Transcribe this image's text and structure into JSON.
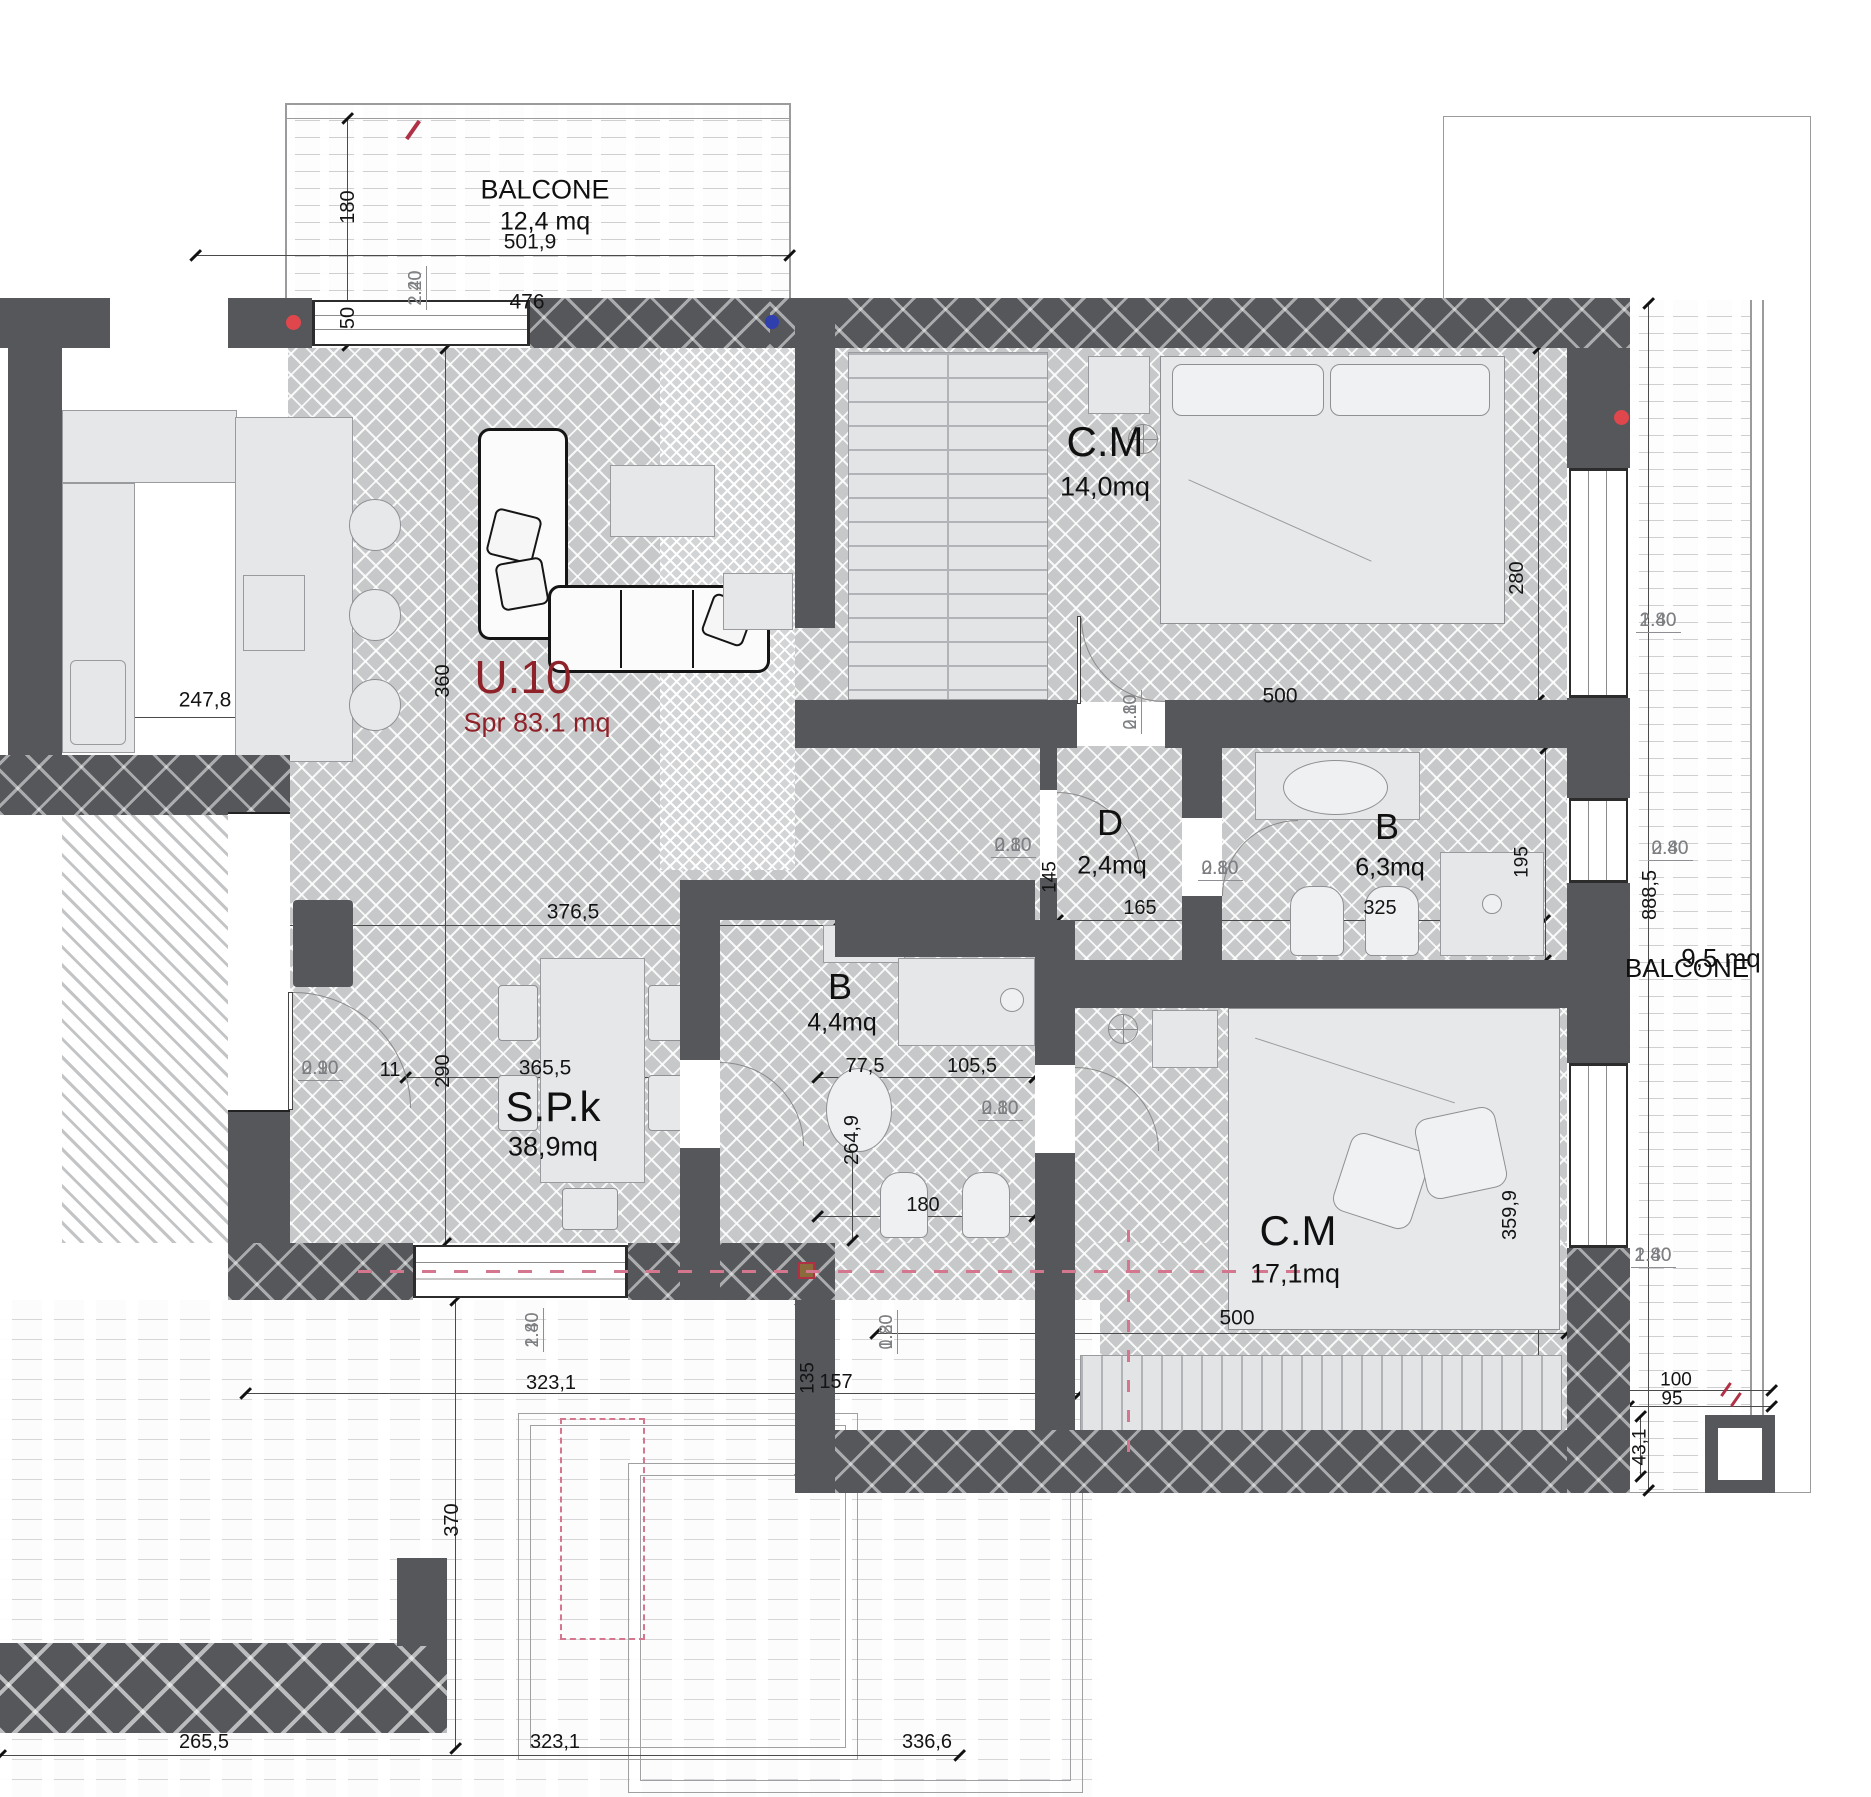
{
  "unit": {
    "id": "U.10",
    "area": "Spr 83.1 mq"
  },
  "rooms": {
    "balcony_top": {
      "name": "BALCONE",
      "area": "12,4 mq"
    },
    "bedroom_top": {
      "name": "C.M",
      "area": "14,0mq"
    },
    "hallway": {
      "name": "D",
      "area": "2,4mq"
    },
    "bathroom_main": {
      "name": "B",
      "area": "6,3mq"
    },
    "bathroom_small": {
      "name": "B",
      "area": "4,4mq"
    },
    "living": {
      "name": "S.P.k",
      "area": "38,9mq"
    },
    "bedroom_bottom": {
      "name": "C.M",
      "area": "17,1mq"
    },
    "balcony_right": {
      "name": "BALCONE",
      "area": "9,5 mq"
    }
  },
  "openings": {
    "balcony_door": {
      "w": "2.20",
      "h": "2.40"
    },
    "entry_door": {
      "w": "0.90",
      "h": "2.10"
    },
    "interior_door": {
      "w": "0.80",
      "h": "2.10"
    },
    "balcony_right_door": {
      "w": "0.80",
      "h": "2.40"
    },
    "window_large": {
      "w": "1.80",
      "h": "2.40"
    },
    "window_small": {
      "w": "0.80",
      "h": "1.20"
    }
  },
  "dims": {
    "balcony_top": {
      "width": "501,9",
      "window": "476",
      "depth": "180",
      "offset": "50"
    },
    "kitchen": {
      "width": "247,8"
    },
    "living": {
      "upper_width": "376,5",
      "upper_height": "360",
      "lower_width": "365,5",
      "lower_height": "290",
      "entry_jamb": "11"
    },
    "bedroom_top": {
      "width": "500",
      "height": "280"
    },
    "hallway": {
      "width": "165",
      "height": "145"
    },
    "bathroom_main": {
      "width": "325",
      "height": "195"
    },
    "bathroom_small": {
      "left": "77,5",
      "right": "105,5",
      "height": "264,9",
      "width": "180"
    },
    "bedroom_bottom": {
      "width": "500",
      "height": "359,9"
    },
    "balcony_right": {
      "length": "888,5",
      "offset_a": "100",
      "offset_b": "95",
      "offset_c": "43,1"
    },
    "terrace": {
      "width": "323,1",
      "depth_a": "135",
      "depth_b": "157",
      "height": "370"
    },
    "bottom_row": {
      "left": "265,5",
      "middle": "323,1",
      "right": "336,6"
    }
  },
  "colors": {
    "wall": "#55575b",
    "floor": "#c7c8ca",
    "accent_red": "#8f2128",
    "dim_gray": "#7d7f82",
    "pink_marker": "#d4768d",
    "red_dot": "#e0474c",
    "blue_dot": "#2f3fae"
  }
}
